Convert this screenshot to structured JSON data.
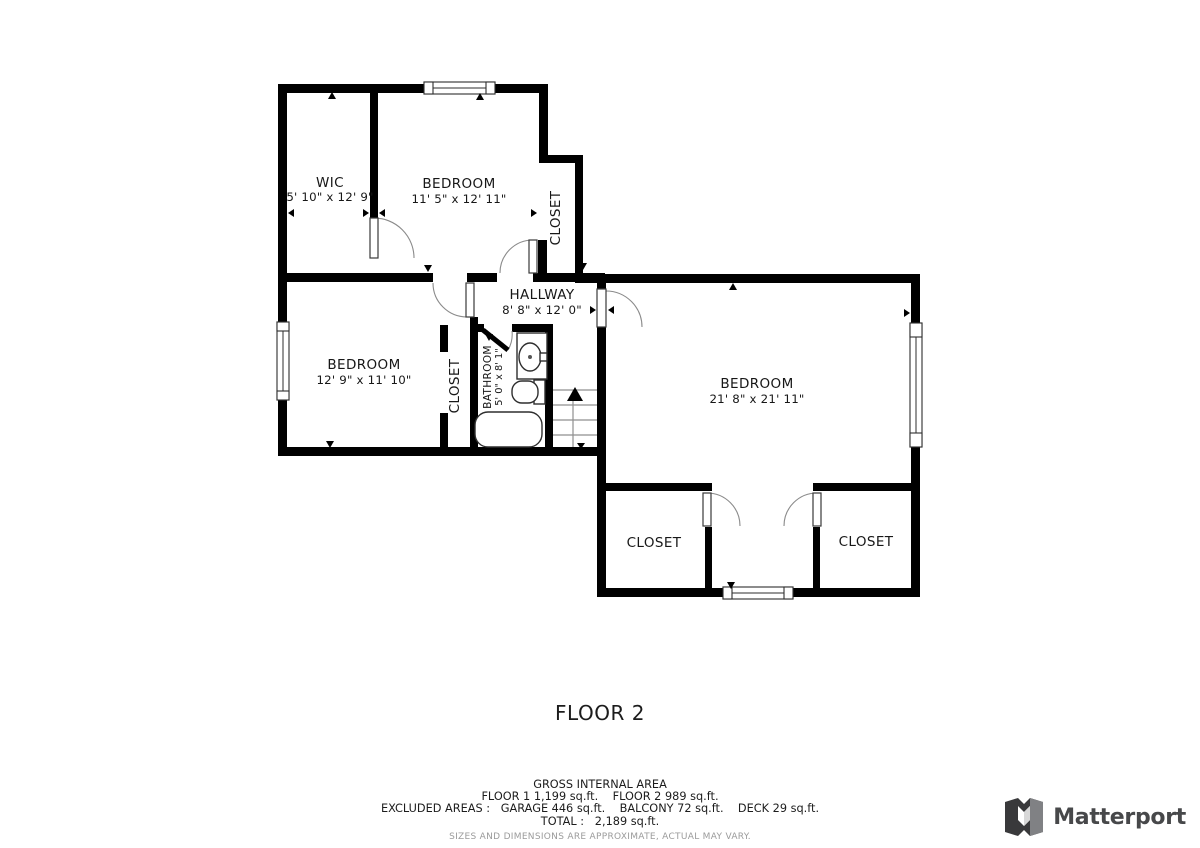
{
  "floorplan": {
    "floor_label": "FLOOR 2",
    "rooms": [
      {
        "name": "WIC",
        "dims": "5' 10\" x 12' 9\""
      },
      {
        "name": "BEDROOM",
        "dims": "11' 5\" x 12' 11\""
      },
      {
        "name": "CLOSET",
        "dims": ""
      },
      {
        "name": "HALLWAY",
        "dims": "8' 8\" x 12' 0\""
      },
      {
        "name": "BEDROOM",
        "dims": "12' 9\" x 11' 10\""
      },
      {
        "name": "CLOSET",
        "dims": ""
      },
      {
        "name": "BATHROOM",
        "dims": "5' 0\" x 8' 1\""
      },
      {
        "name": "BEDROOM",
        "dims": "21' 8\" x 21' 11\""
      },
      {
        "name": "CLOSET",
        "dims": ""
      },
      {
        "name": "CLOSET",
        "dims": ""
      }
    ]
  },
  "summary": {
    "title": "GROSS INTERNAL AREA",
    "floors_line": "FLOOR 1 1,199 sq.ft.    FLOOR 2 989 sq.ft.",
    "excluded_line": "EXCLUDED AREAS :   GARAGE 446 sq.ft.    BALCONY 72 sq.ft.    DECK 29 sq.ft.",
    "total_line": "TOTAL :   2,189 sq.ft.",
    "disclaimer": "SIZES AND DIMENSIONS ARE APPROXIMATE, ACTUAL MAY VARY."
  },
  "branding": {
    "wordmark": "Matterport"
  },
  "colors": {
    "wall": "#000000",
    "text": "#171717",
    "disclaimer_text": "#9b9b9b",
    "logo_dark": "#39393b",
    "logo_gray": "#808184",
    "wordmark": "#47484a"
  }
}
